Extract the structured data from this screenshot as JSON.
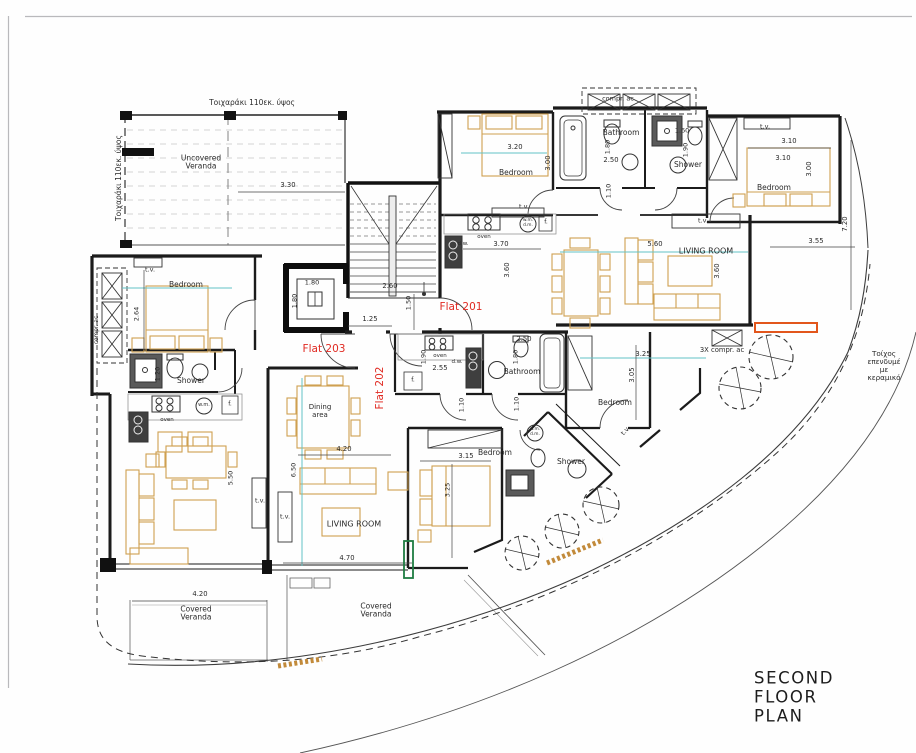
{
  "title": "SECOND FLOOR PLAN",
  "colors": {
    "label_red": "#e02a22",
    "dimension_teal": "#63c3c5",
    "furniture_tan": "#cfa050",
    "highlight_orange": "#e2561c",
    "highlight_green": "#1e7c42",
    "hatch_orange": "#c28a3a",
    "wall_black": "#1b1b1b"
  },
  "labels": [
    {
      "t": "Τοιχαράκι 110εκ. ύψος",
      "x": 252,
      "y": 103,
      "s": 7.5
    },
    {
      "t": "compr. ac",
      "x": 618,
      "y": 99,
      "s": 6.5
    },
    {
      "t": "t.v.",
      "x": 765,
      "y": 127,
      "s": 6.5
    },
    {
      "t": "1.60",
      "x": 682,
      "y": 131,
      "s": 6.5
    },
    {
      "t": "Bathroom",
      "x": 621,
      "y": 133,
      "s": 7.5
    },
    {
      "t": "3.10",
      "x": 789,
      "y": 142,
      "s": 6.8
    },
    {
      "t": "1.80",
      "x": 608,
      "y": 147,
      "s": 6.5,
      "r": -90
    },
    {
      "t": "3.20",
      "x": 515,
      "y": 148,
      "s": 6.8
    },
    {
      "t": "1.90",
      "x": 686,
      "y": 150,
      "s": 6.5,
      "r": -90
    },
    {
      "t": "3.10",
      "x": 783,
      "y": 159,
      "s": 6.8
    },
    {
      "t": "2.50",
      "x": 611,
      "y": 161,
      "s": 6.8
    },
    {
      "t": "3.00",
      "x": 549,
      "y": 163,
      "s": 6.8,
      "r": -90
    },
    {
      "t": "Shower",
      "x": 688,
      "y": 165,
      "s": 7.5
    },
    {
      "t": "Uncovered\nVeranda",
      "x": 201,
      "y": 163,
      "s": 7.5
    },
    {
      "t": "3.00",
      "x": 810,
      "y": 169,
      "s": 6.8,
      "r": -90
    },
    {
      "t": "Bedroom",
      "x": 516,
      "y": 173,
      "s": 7.5
    },
    {
      "t": "Τοιχαράκι 110εκ. ύψος",
      "x": 119,
      "y": 178,
      "s": 7.5,
      "r": -90
    },
    {
      "t": "3.30",
      "x": 288,
      "y": 186,
      "s": 6.8
    },
    {
      "t": "Bedroom",
      "x": 774,
      "y": 188,
      "s": 7.5
    },
    {
      "t": "1.10",
      "x": 609,
      "y": 191,
      "s": 6.5,
      "r": -90
    },
    {
      "t": "t.v.",
      "x": 524,
      "y": 207,
      "s": 6.5
    },
    {
      "t": "t.v.",
      "x": 703,
      "y": 221,
      "s": 6.5
    },
    {
      "t": "w.m.\nd.m.",
      "x": 528,
      "y": 224,
      "s": 4.3
    },
    {
      "t": "f.",
      "x": 546,
      "y": 223,
      "s": 6
    },
    {
      "t": "7.20",
      "x": 846,
      "y": 224,
      "s": 6.8,
      "r": -90
    },
    {
      "t": "oven",
      "x": 484,
      "y": 237,
      "s": 5.5
    },
    {
      "t": "3.55",
      "x": 816,
      "y": 242,
      "s": 6.8
    },
    {
      "t": "d.w.",
      "x": 463,
      "y": 244,
      "s": 5.5
    },
    {
      "t": "3.70",
      "x": 501,
      "y": 245,
      "s": 6.8
    },
    {
      "t": "5.60",
      "x": 655,
      "y": 245,
      "s": 6.8
    },
    {
      "t": "LIVING ROOM",
      "x": 706,
      "y": 252,
      "s": 8
    },
    {
      "t": "3.60",
      "x": 508,
      "y": 270,
      "s": 6.8,
      "r": -90
    },
    {
      "t": "3.60",
      "x": 718,
      "y": 271,
      "s": 6.8,
      "r": -90
    },
    {
      "t": "t.v.",
      "x": 150,
      "y": 270,
      "s": 6.5
    },
    {
      "t": "1.80",
      "x": 312,
      "y": 283,
      "s": 6.5
    },
    {
      "t": "Bedroom",
      "x": 186,
      "y": 285,
      "s": 7.5
    },
    {
      "t": "2.60",
      "x": 390,
      "y": 287,
      "s": 6.8
    },
    {
      "t": "1.80",
      "x": 295,
      "y": 301,
      "s": 6.5,
      "r": -90
    },
    {
      "t": "1.50",
      "x": 409,
      "y": 303,
      "s": 6.5,
      "r": -90
    },
    {
      "t": "Flat 201",
      "x": 461,
      "y": 308,
      "s": 10.5,
      "c": "r"
    },
    {
      "t": "2.64",
      "x": 137,
      "y": 314,
      "s": 6.5,
      "r": -90
    },
    {
      "t": "1.25",
      "x": 370,
      "y": 320,
      "s": 6.8
    },
    {
      "t": "compr. ac",
      "x": 97,
      "y": 330,
      "s": 5.8,
      "r": -90
    },
    {
      "t": "2.50",
      "x": 524,
      "y": 340,
      "s": 6.8
    },
    {
      "t": "Flat 203",
      "x": 324,
      "y": 350,
      "s": 10.5,
      "c": "r"
    },
    {
      "t": "oven",
      "x": 440,
      "y": 356,
      "s": 5.5
    },
    {
      "t": "3.25",
      "x": 643,
      "y": 355,
      "s": 6.8
    },
    {
      "t": "3X compr. ac",
      "x": 722,
      "y": 351,
      "s": 6.8
    },
    {
      "t": "1.80",
      "x": 516,
      "y": 357,
      "s": 6.5,
      "r": -90
    },
    {
      "t": "1.90",
      "x": 424,
      "y": 357,
      "s": 6.5,
      "r": -90
    },
    {
      "t": "Τοίχος επενδυμέ\nμε κεραμικό",
      "x": 884,
      "y": 366,
      "s": 7.2
    },
    {
      "t": "d.w.",
      "x": 457,
      "y": 362,
      "s": 5.5
    },
    {
      "t": "2.55",
      "x": 440,
      "y": 369,
      "s": 6.8
    },
    {
      "t": "Bathroom",
      "x": 522,
      "y": 372,
      "s": 7.5
    },
    {
      "t": "1.20",
      "x": 158,
      "y": 374,
      "s": 6.5,
      "r": -90
    },
    {
      "t": "3.05",
      "x": 633,
      "y": 375,
      "s": 6.8,
      "r": -90
    },
    {
      "t": "Shower",
      "x": 191,
      "y": 381,
      "s": 7.5
    },
    {
      "t": "f.",
      "x": 413,
      "y": 381,
      "s": 6
    },
    {
      "t": "Flat 202",
      "x": 381,
      "y": 388,
      "s": 10.5,
      "c": "r",
      "r": -90
    },
    {
      "t": "Bedroom",
      "x": 615,
      "y": 403,
      "s": 7.5
    },
    {
      "t": "1.10",
      "x": 462,
      "y": 405,
      "s": 6.5,
      "r": -90
    },
    {
      "t": "1.10",
      "x": 517,
      "y": 404,
      "s": 6.5,
      "r": -90
    },
    {
      "t": "w.m.",
      "x": 204,
      "y": 406,
      "s": 5
    },
    {
      "t": "f.",
      "x": 230,
      "y": 405,
      "s": 6
    },
    {
      "t": "Dining\narea",
      "x": 320,
      "y": 412,
      "s": 7
    },
    {
      "t": "oven",
      "x": 167,
      "y": 420,
      "s": 5.5
    },
    {
      "t": "w.m.\nd.m.",
      "x": 535,
      "y": 433,
      "s": 4.3
    },
    {
      "t": "t.v.",
      "x": 626,
      "y": 431,
      "s": 6.5,
      "r": -48
    },
    {
      "t": "4.20",
      "x": 344,
      "y": 450,
      "s": 6.8
    },
    {
      "t": "Bedroom",
      "x": 495,
      "y": 453,
      "s": 7.5
    },
    {
      "t": "3.15",
      "x": 466,
      "y": 457,
      "s": 6.8
    },
    {
      "t": "Shower",
      "x": 571,
      "y": 462,
      "s": 7.5
    },
    {
      "t": "6.50",
      "x": 294,
      "y": 470,
      "s": 6.5,
      "r": -90
    },
    {
      "t": "5.50",
      "x": 231,
      "y": 478,
      "s": 6.5,
      "r": -90
    },
    {
      "t": "3.25",
      "x": 448,
      "y": 490,
      "s": 6.5,
      "r": -90
    },
    {
      "t": "t.v.",
      "x": 260,
      "y": 501,
      "s": 6.5
    },
    {
      "t": "t.v.",
      "x": 285,
      "y": 517,
      "s": 6.5
    },
    {
      "t": "LIVING ROOM",
      "x": 354,
      "y": 525,
      "s": 8
    },
    {
      "t": "4.70",
      "x": 347,
      "y": 559,
      "s": 6.8
    },
    {
      "t": "4.20",
      "x": 200,
      "y": 595,
      "s": 6.8
    },
    {
      "t": "Covered\nVeranda",
      "x": 196,
      "y": 614,
      "s": 7.5
    },
    {
      "t": "Covered\nVeranda",
      "x": 376,
      "y": 611,
      "s": 7.5
    }
  ]
}
